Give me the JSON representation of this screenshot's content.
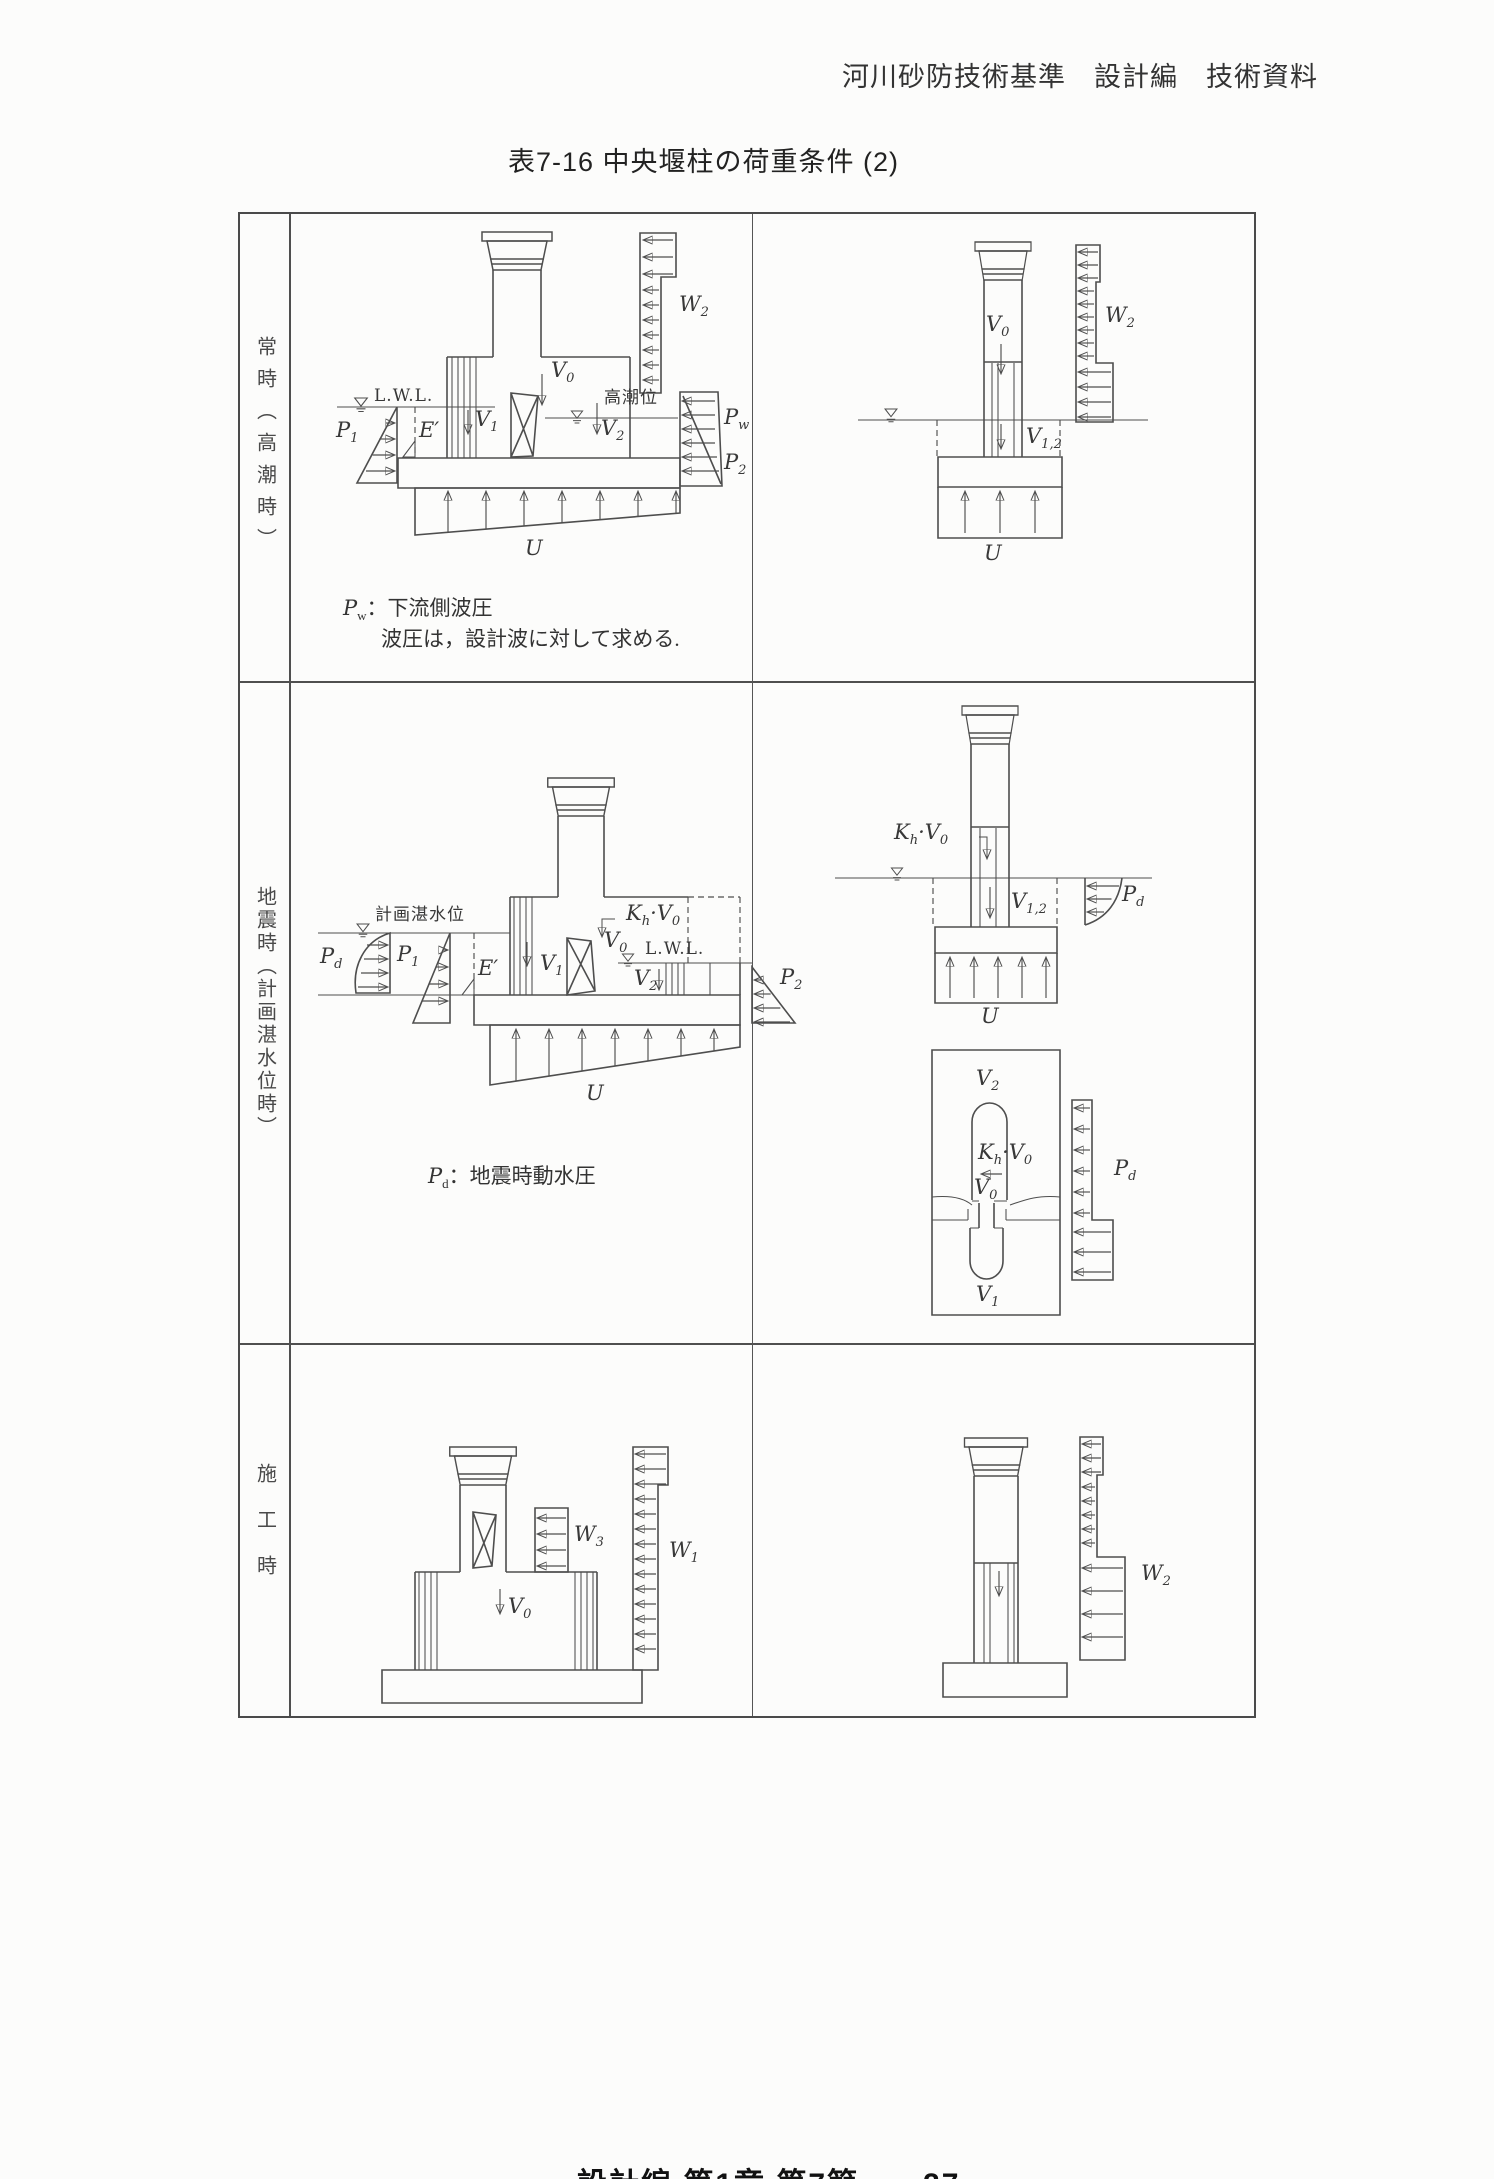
{
  "page": {
    "header": "河川砂防技術基準　設計編　技術資料",
    "title": "表7-16 中央堰柱の荷重条件 (2)",
    "footer": "設計編 第1章 第7節　　27"
  },
  "table": {
    "rows": [
      {
        "label": "常時（高潮時）"
      },
      {
        "label": "地震時（計画湛水位時）"
      },
      {
        "label": "施工時"
      }
    ]
  },
  "diagram_labels": [
    {
      "x": 551,
      "y": 360,
      "t": "V_{0}"
    },
    {
      "x": 374,
      "y": 388,
      "t": "L.W.L.",
      "c": "rm"
    },
    {
      "x": 336,
      "y": 420,
      "t": "P_{1}"
    },
    {
      "x": 419,
      "y": 420,
      "t": "E′"
    },
    {
      "x": 475,
      "y": 409,
      "t": "V_{1}"
    },
    {
      "x": 604,
      "y": 389,
      "t": "高潮位",
      "c": "jp"
    },
    {
      "x": 601,
      "y": 418,
      "t": "V_{2}"
    },
    {
      "x": 679,
      "y": 294,
      "t": "W_{2}"
    },
    {
      "x": 724,
      "y": 407,
      "t": "P_{w}"
    },
    {
      "x": 724,
      "y": 452,
      "t": "P_{2}"
    },
    {
      "x": 525,
      "y": 538,
      "t": "U"
    },
    {
      "x": 343,
      "y": 598,
      "t": "*P*_{w}：下流側波圧",
      "c": "cap"
    },
    {
      "x": 381,
      "y": 629,
      "t": "波圧は，設計波に対して求める.",
      "c": "cap"
    },
    {
      "x": 986,
      "y": 314,
      "t": "V_{0}"
    },
    {
      "x": 1105,
      "y": 305,
      "t": "W_{2}"
    },
    {
      "x": 1026,
      "y": 426,
      "t": "V_{1,2}"
    },
    {
      "x": 984,
      "y": 543,
      "t": "U"
    },
    {
      "x": 375,
      "y": 906,
      "t": "計画湛水位",
      "c": "jp"
    },
    {
      "x": 320,
      "y": 946,
      "t": "P_{d}"
    },
    {
      "x": 397,
      "y": 944,
      "t": "P_{1}"
    },
    {
      "x": 478,
      "y": 958,
      "t": "E′"
    },
    {
      "x": 540,
      "y": 953,
      "t": "V_{1}"
    },
    {
      "x": 604,
      "y": 930,
      "t": "V_{0}"
    },
    {
      "x": 626,
      "y": 903,
      "t": "K_{h}·V_{0}"
    },
    {
      "x": 645,
      "y": 941,
      "t": "L.W.L.",
      "c": "rm"
    },
    {
      "x": 634,
      "y": 968,
      "t": "V_{2}"
    },
    {
      "x": 780,
      "y": 967,
      "t": "P_{2}"
    },
    {
      "x": 586,
      "y": 1083,
      "t": "U"
    },
    {
      "x": 428,
      "y": 1166,
      "t": "*P*_{d}：地震時動水圧",
      "c": "cap"
    },
    {
      "x": 894,
      "y": 822,
      "t": "K_{h}·V_{0}"
    },
    {
      "x": 1011,
      "y": 891,
      "t": "V_{1,2}"
    },
    {
      "x": 1122,
      "y": 884,
      "t": "P_{d}"
    },
    {
      "x": 981,
      "y": 1006,
      "t": "U"
    },
    {
      "x": 976,
      "y": 1068,
      "t": "V_{2}"
    },
    {
      "x": 978,
      "y": 1142,
      "t": "K_{h}·V_{0}"
    },
    {
      "x": 974,
      "y": 1177,
      "t": "V_{0}"
    },
    {
      "x": 976,
      "y": 1284,
      "t": "V_{1}"
    },
    {
      "x": 1114,
      "y": 1158,
      "t": "P_{d}"
    },
    {
      "x": 574,
      "y": 1524,
      "t": "W_{3}"
    },
    {
      "x": 669,
      "y": 1540,
      "t": "W_{1}"
    },
    {
      "x": 508,
      "y": 1596,
      "t": "V_{0}"
    },
    {
      "x": 1141,
      "y": 1563,
      "t": "W_{2}"
    }
  ]
}
